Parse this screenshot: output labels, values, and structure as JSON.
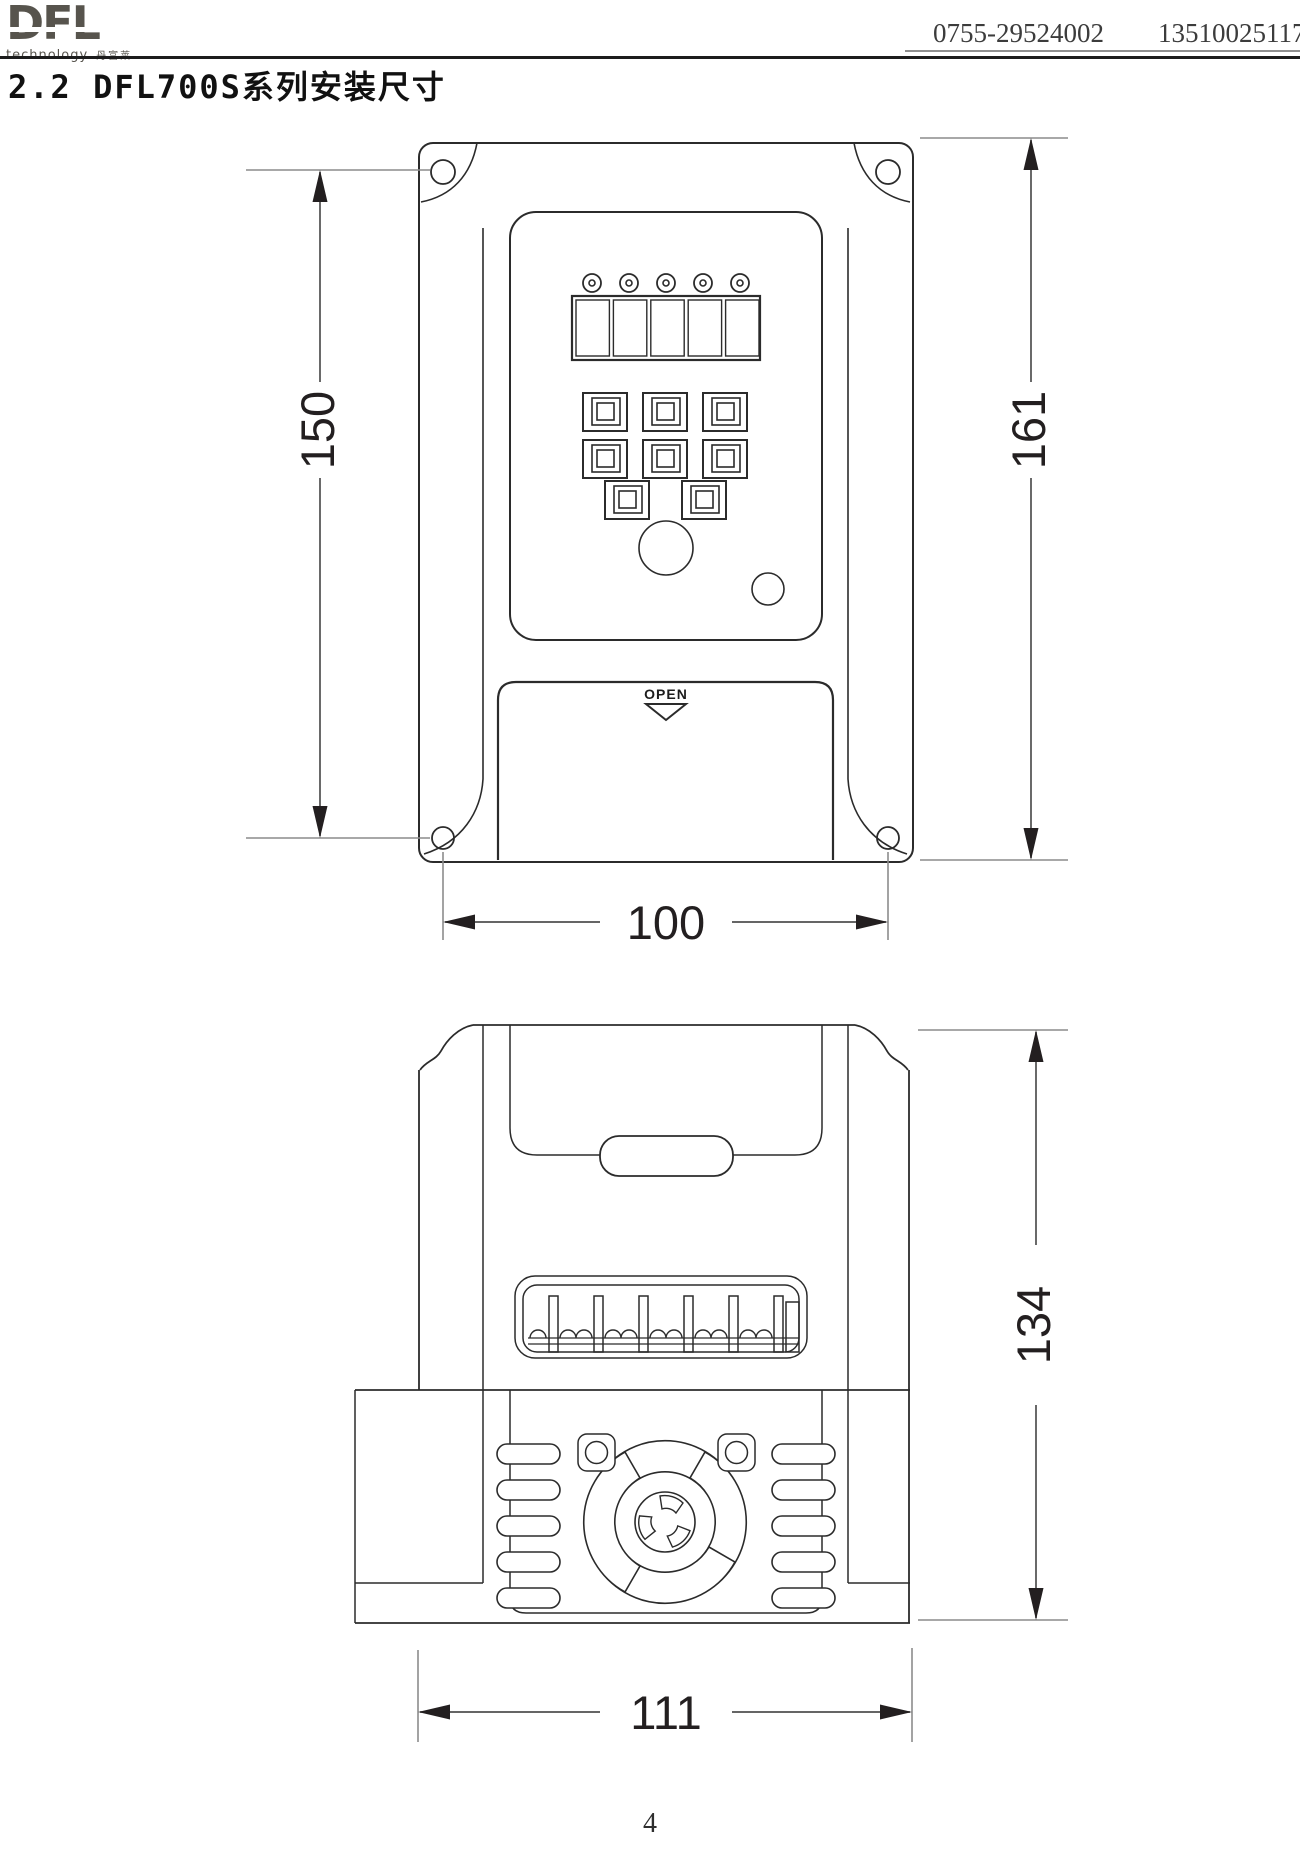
{
  "header": {
    "logo": {
      "brand": "DFL",
      "tagline": "technology",
      "cjk": "丹富莱"
    },
    "phone1": "0755-29524002",
    "phone2": "13510025117"
  },
  "title": "2.2 DFL700S系列安装尺寸",
  "front_view": {
    "open_label": "OPEN",
    "dims": {
      "mount_height": "150",
      "total_height": "161",
      "mount_width": "100"
    }
  },
  "side_view": {
    "dims": {
      "body_height": "134",
      "body_width": "111"
    }
  },
  "footer": {
    "page_number": "4"
  }
}
